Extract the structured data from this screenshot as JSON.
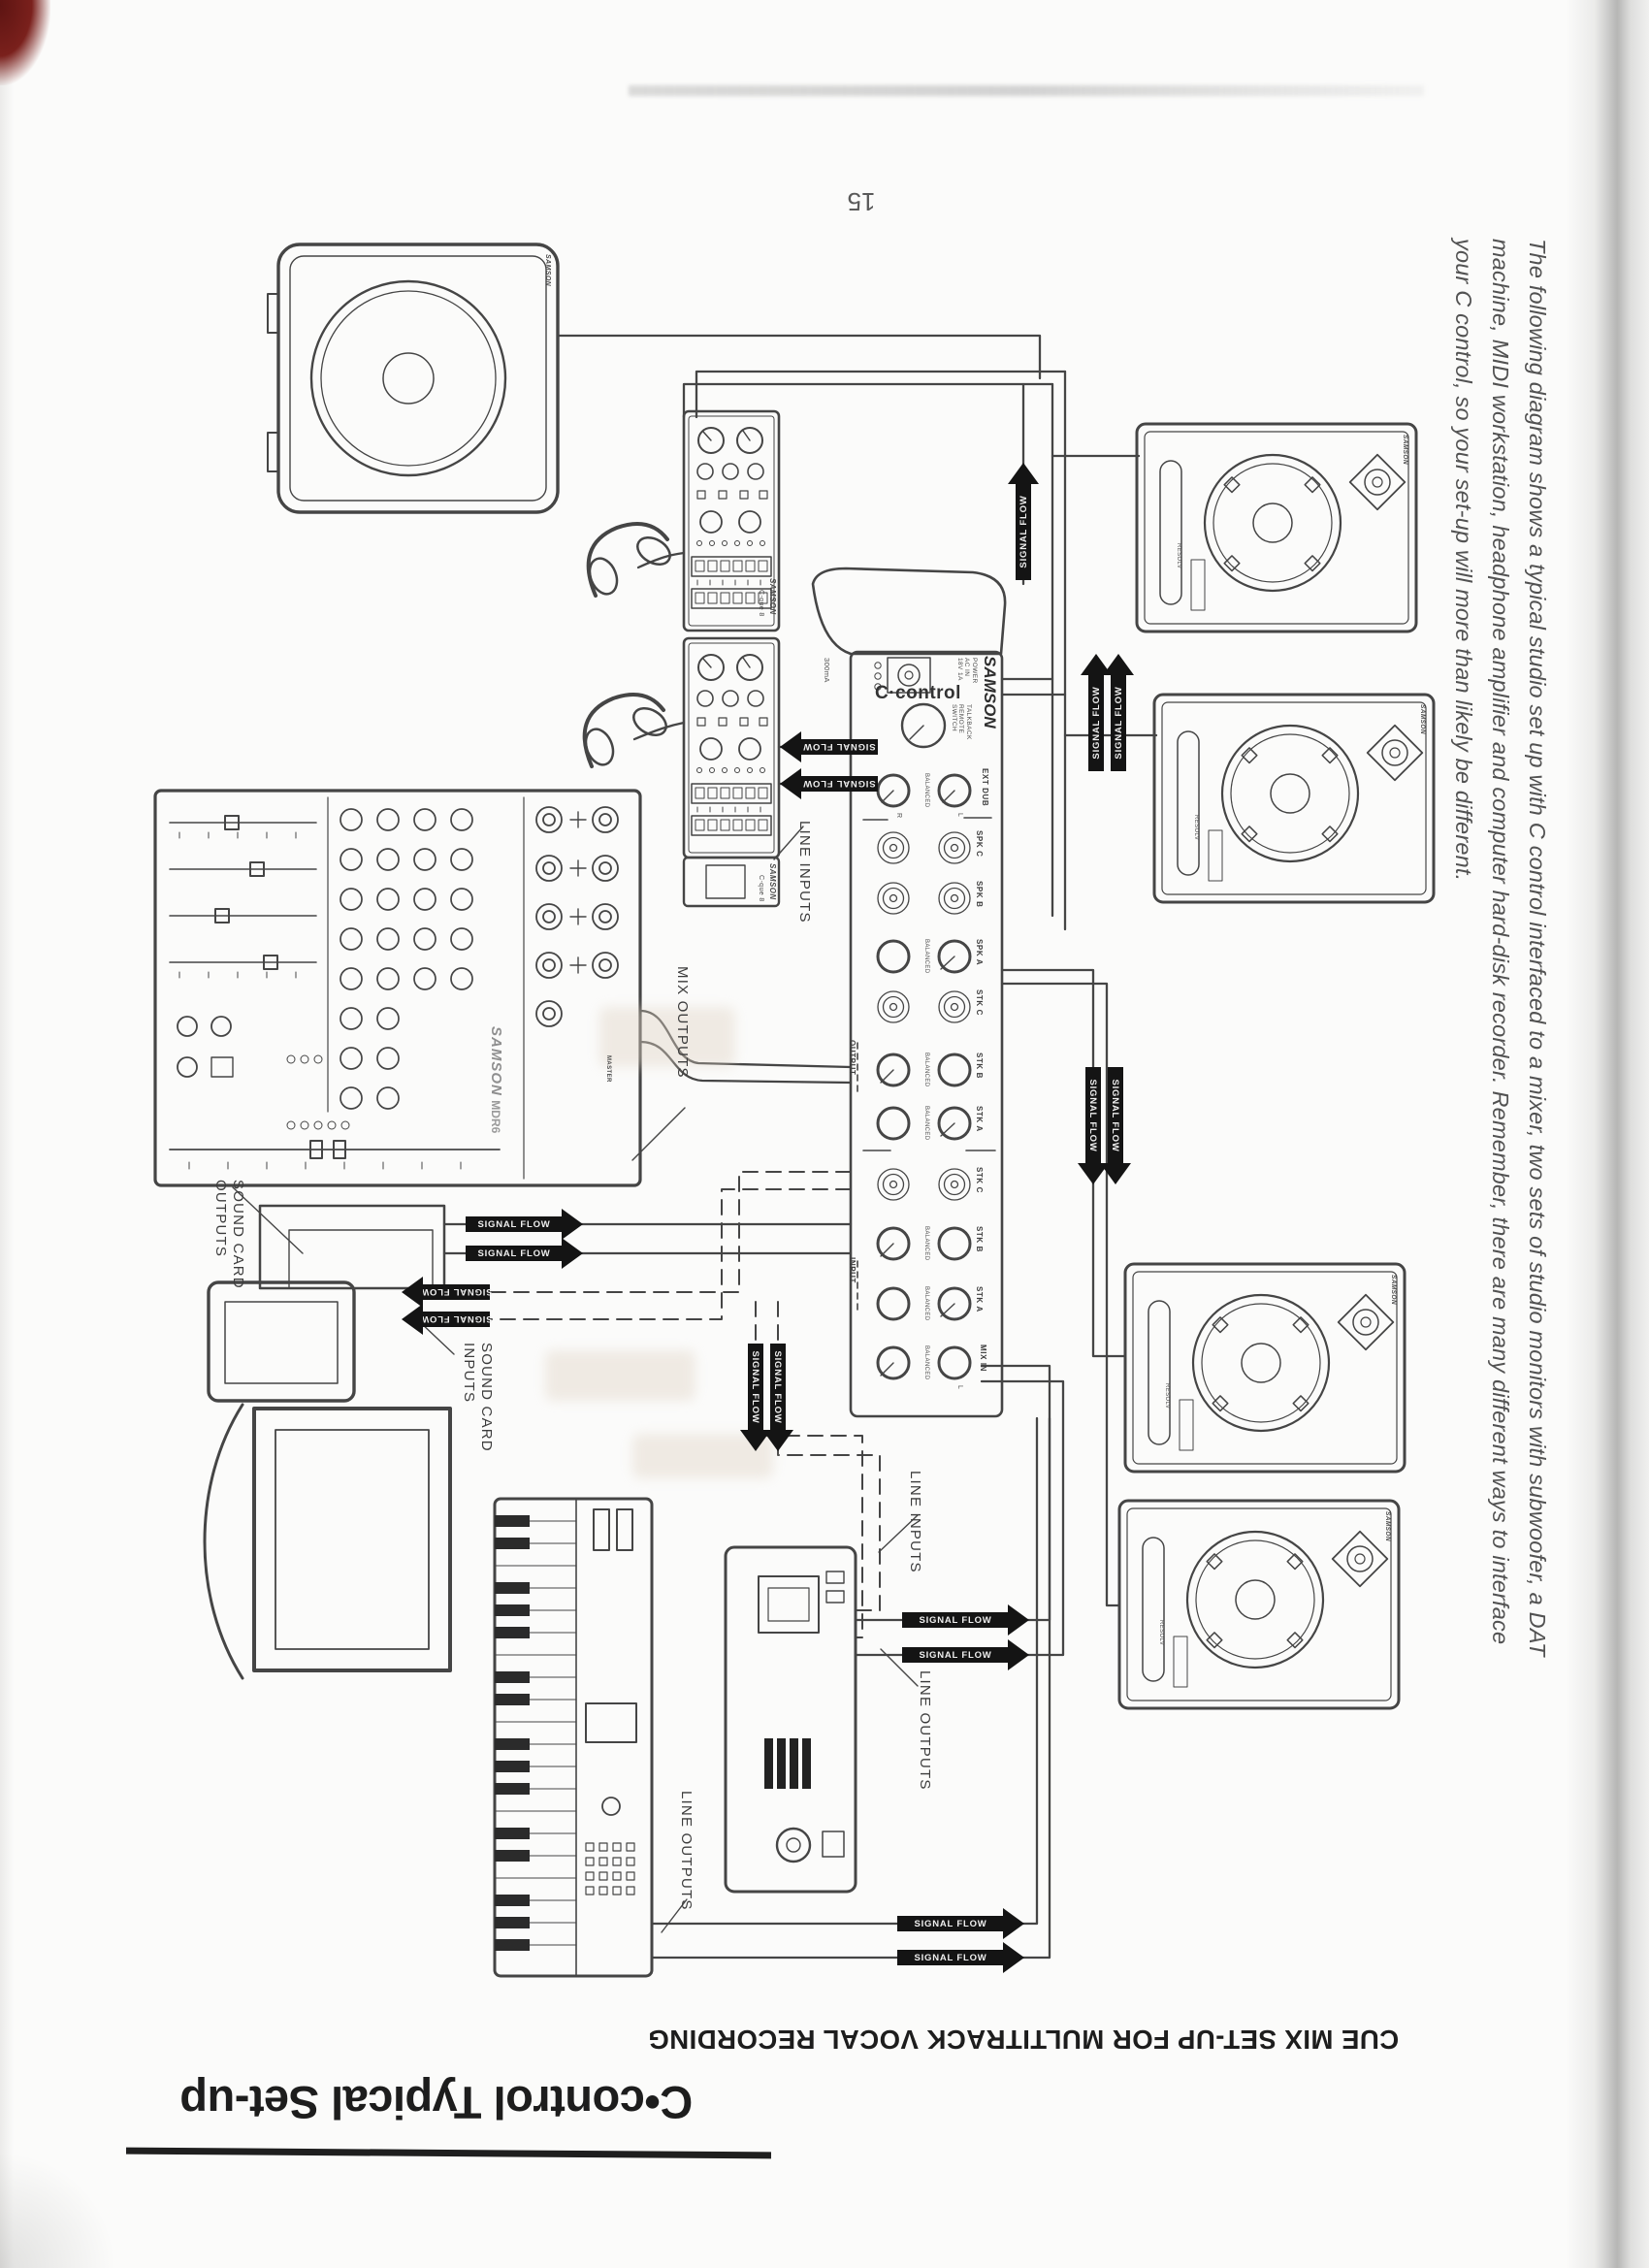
{
  "page": {
    "number": "15",
    "title": "C•control Typical Set-up",
    "subtitle": "CUE MIX SET-UP FOR MULTITRACK VOCAL RECORDING",
    "intro": {
      "line1": "The following diagram shows a typical studio set up with C control interfaced to a mixer, two sets of studio monitors with subwoofer, a DAT",
      "line2": "machine, MIDI workstation, headphone amplifier and computer hard-disk recorder. Remember, there are many different ways to interface",
      "line3": "your C control, so your set-up will more than likely be different."
    }
  },
  "labels": {
    "signal_flow": "SIGNAL FLOW",
    "line_inputs": "LINE INPUTS",
    "mix_outputs": "MIX OUTPUTS",
    "sound_card": "SOUND CARD",
    "outputs": "OUTPUTS",
    "inputs": "INPUTS",
    "line_outputs": "LINE OUTPUTS"
  },
  "c_control": {
    "brand": "SAMSON",
    "model": "C·control",
    "power_line1": "POWER",
    "power_line2": "AC IN",
    "power_line3": "18V 1A",
    "power_ma": "300mA",
    "talkback_line1": "TALKBACK",
    "talkback_line2": "REMOTE",
    "talkback_line3": "SWITCH",
    "section_output": "OUTPUT",
    "section_input": "INPUT",
    "balanced": "BALANCED",
    "left": "L",
    "right": "R",
    "jack_rows": [
      {
        "label": "EXT DUB"
      },
      {
        "label": "SPK C"
      },
      {
        "label": "SPK B"
      },
      {
        "label": "SPK A"
      },
      {
        "label": "STK C"
      },
      {
        "label": "STK B"
      },
      {
        "label": "STK A"
      },
      {
        "label": "STK C"
      },
      {
        "label": "STK B"
      },
      {
        "label": "STK A"
      },
      {
        "label": "MIX IN"
      }
    ]
  },
  "headphone_amp": {
    "brand": "SAMSON",
    "model": "C-que 8"
  },
  "mixer": {
    "brand": "SAMSON",
    "model": "MDR6",
    "master": "MASTER"
  },
  "monitor": {
    "brand": "SAMSON",
    "series": "RESOLV"
  },
  "subwoofer": {
    "brand": "SAMSON"
  }
}
